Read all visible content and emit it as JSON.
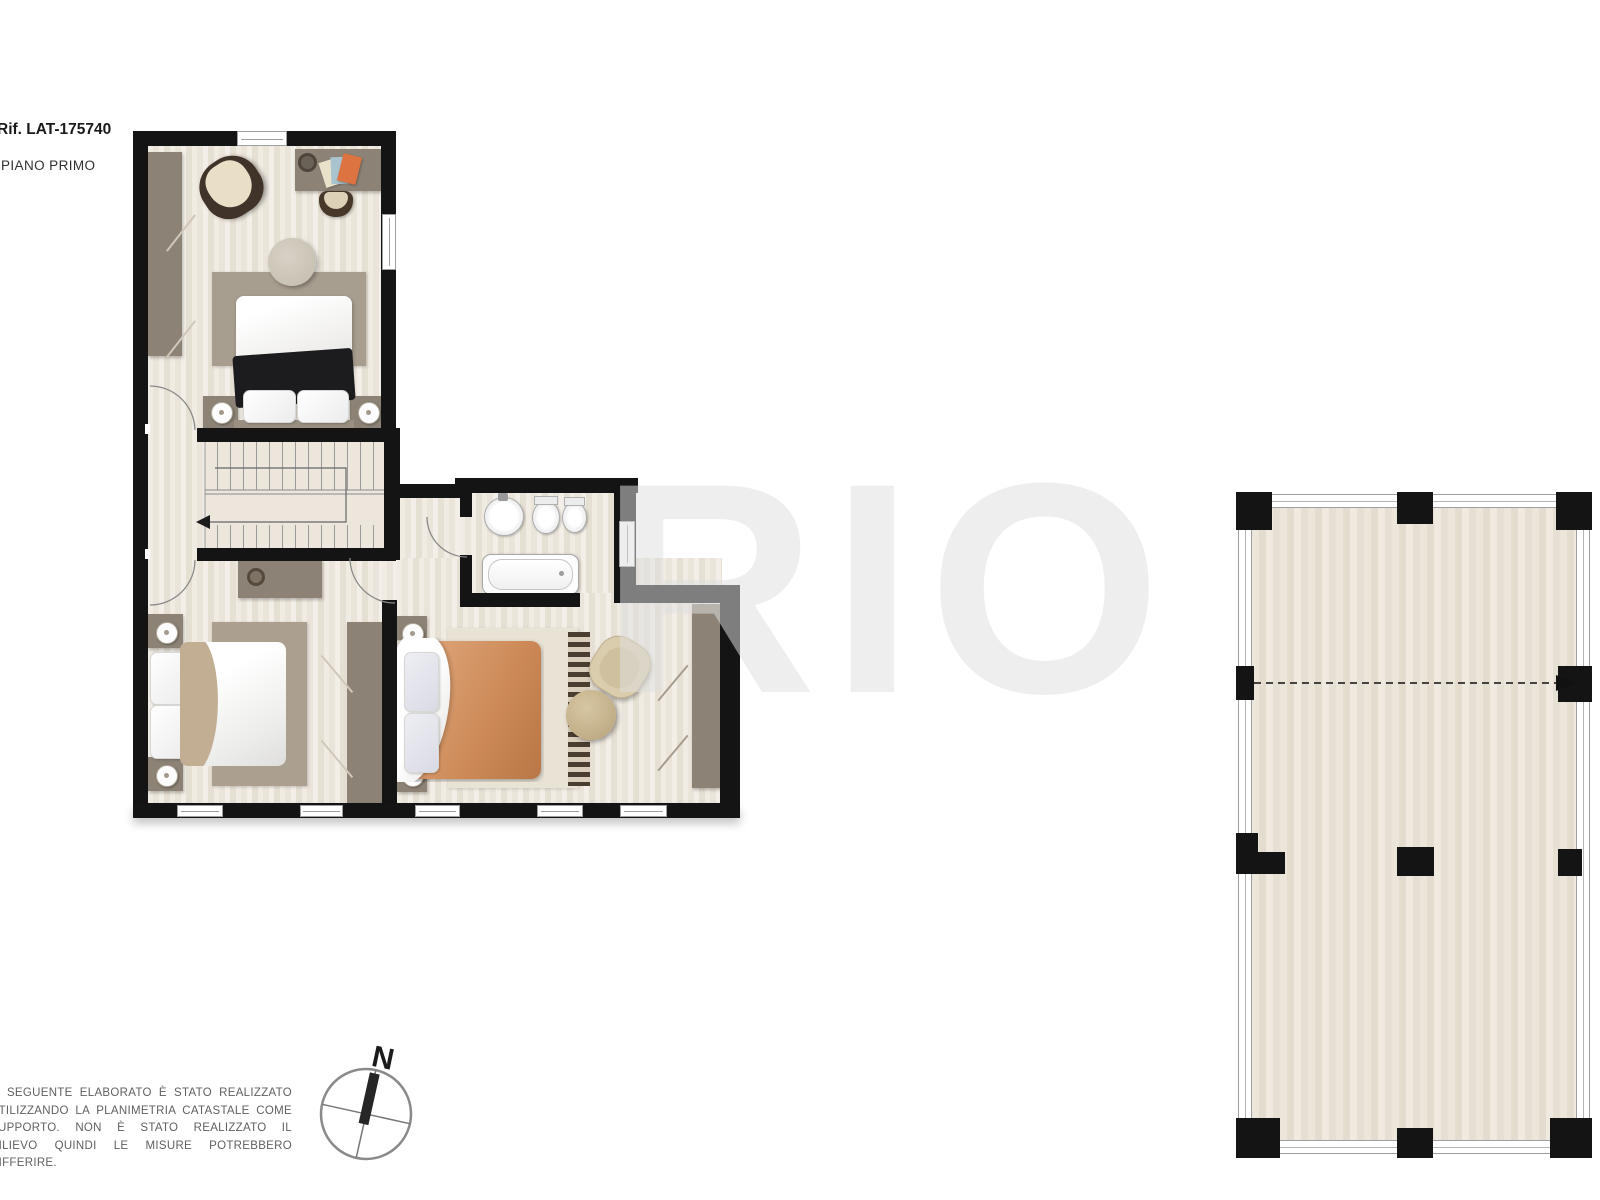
{
  "header": {
    "reference": "Rif. LAT-175740",
    "floor_label": "PIANO PRIMO"
  },
  "watermark": {
    "text": "RIO"
  },
  "compass": {
    "label": "N"
  },
  "disclaimer": {
    "text": "IL SEGUENTE ELABORATO È STATO REALIZZATO UTILIZZANDO LA PLANIMETRIA CATASTALE COME SUPPORTO. NON È STATO REALIZZATO IL RILIEVO QUINDI LE MISURE POTREBBERO DIFFERIRE."
  },
  "colors": {
    "wall": "#141414",
    "floor": "#f0ebe3",
    "stair": "#ece6dc",
    "furn": "#8c8376",
    "rug": "#a89e90",
    "rug2": "#aba08f",
    "orange": "#cd8a58",
    "wm": "#e0e0e0"
  }
}
